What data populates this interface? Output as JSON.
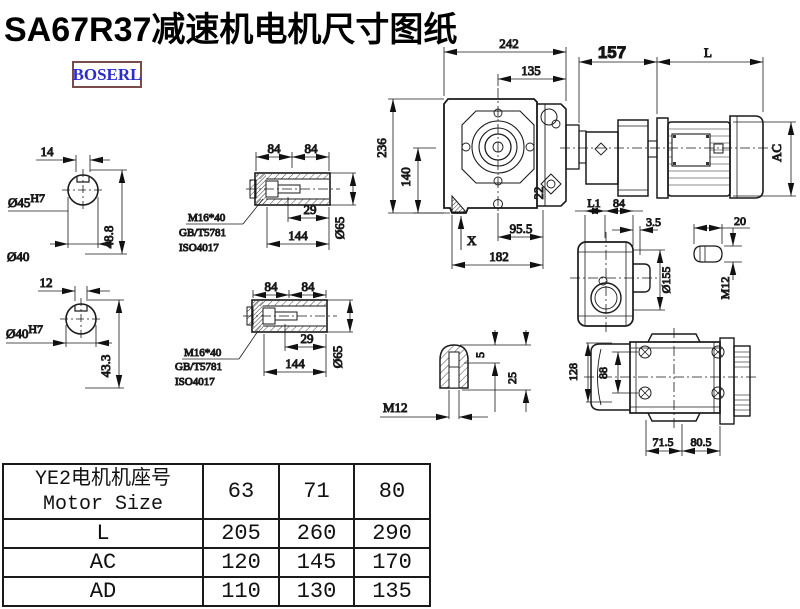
{
  "title": "SA67R37减速机电机尺寸图纸",
  "logo": "BOSERL",
  "colors": {
    "line": "#1a1a1a",
    "logo_text": "#2b2bd0",
    "logo_border": "#7b4b4b",
    "table_border": "#1a1a1a"
  },
  "dims": {
    "shaft_a": {
      "width": "14",
      "bore": "Ø45",
      "tol": "H7",
      "depth": "48.8",
      "note": "Ø40"
    },
    "shaft_b": {
      "width": "12",
      "bore": "Ø40",
      "tol": "H7",
      "depth": "43.3"
    },
    "sleeve": {
      "len1": "84",
      "len2": "84",
      "bolt_len": "29",
      "total": "144",
      "od": "Ø65",
      "bolt": "M16*40",
      "std1": "GB/T5781",
      "std2": "ISO4017"
    },
    "main": {
      "w242": "242",
      "w135": "135",
      "w157": "157",
      "L": "L",
      "h236": "236",
      "h140": "140",
      "d22": "22",
      "x": "X",
      "w955": "95.5",
      "w182": "182",
      "ac": "AC"
    },
    "side": {
      "l1": "L1",
      "w84": "84",
      "w35": "3.5",
      "od": "Ø155",
      "w20": "20",
      "m12": "M12"
    },
    "bottom": {
      "h128": "128",
      "h88": "88",
      "w715": "71.5",
      "w805": "80.5"
    },
    "detail": {
      "d5": "5",
      "d25": "25",
      "m12": "M12"
    }
  },
  "table": {
    "header": {
      "title_cn": "YE2电机机座号",
      "title_en": "Motor Size",
      "sizes": [
        "63",
        "71",
        "80"
      ]
    },
    "rows": [
      {
        "label": "L",
        "values": [
          "205",
          "260",
          "290"
        ]
      },
      {
        "label": "AC",
        "values": [
          "120",
          "145",
          "170"
        ]
      },
      {
        "label": "AD",
        "values": [
          "110",
          "130",
          "135"
        ]
      }
    ]
  }
}
